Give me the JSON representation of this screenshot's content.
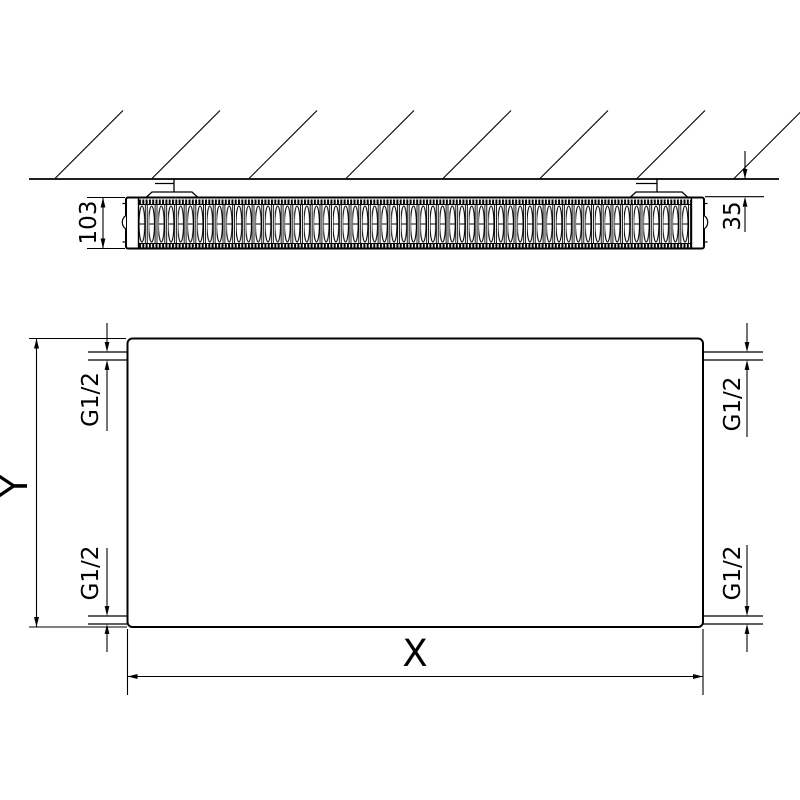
{
  "drawing": {
    "background": "#ffffff",
    "line_color": "#000000"
  },
  "top_view": {
    "depth_dimension": "103",
    "wall_gap_dimension": "35"
  },
  "front_view": {
    "width_dimension": "X",
    "height_dimension": "Y",
    "connection_labels": [
      "G1/2",
      "G1/2",
      "G1/2",
      "G1/2"
    ]
  }
}
